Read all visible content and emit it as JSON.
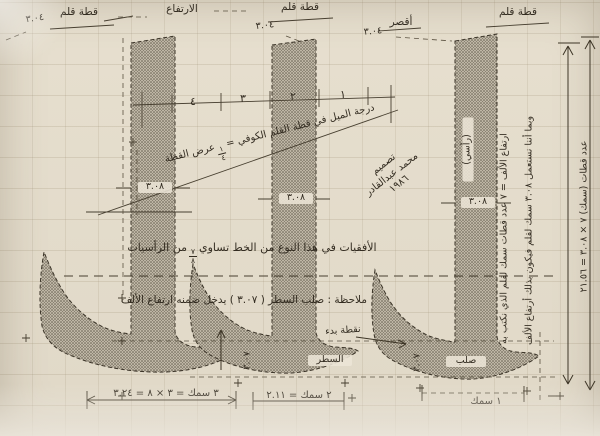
{
  "labels": {
    "pen_cut": "قطة قلم",
    "pen_cut_value": "٣.٠٤",
    "height": "الارتفاع",
    "shorter": "أقصر",
    "ruler_ticks": [
      "٤",
      "٣",
      "٢",
      "١"
    ],
    "slant_pre": "درجة الميل في قطة القلم الكوفي =",
    "slant_frac_num": "١",
    "slant_frac_den": "٤",
    "slant_post": "عرض القطة",
    "stroke_width": "٣.٠٨",
    "vertical": "(رأسي)",
    "horizontals_pre": "الأفقيات في هذا النوع من الخط تساوي",
    "horizontals_frac_num": "٧",
    "horizontals_frac_den": "٨",
    "horizontals_post": "من الرأسيات",
    "note_line": "ملاحظة : صلب السطر ( ٣.٠٧ ) يدخل ضمنه ارتفاع الألف",
    "the_line": "السطر",
    "solid": "صلب",
    "signature_1": "تصميم",
    "signature_2": "محمد عبدالقادر",
    "signature_3": "١٩٨٦",
    "right_line_1": "ارتفاع الألف = ٧ عدد قطات سمك لقلم الذي نكتب به",
    "right_line_2": "وبما أننا نستعمل ٣.٠٨ سمك لقلم فيكون بذلك أرتفاع الألف",
    "right_line_3": "عدد قطات (سمك) ٧ × ٣.٠٨ = ٢١.٥٦",
    "dim_1": "٣ سمك = ٣ × ٨ = ٣.٢٤",
    "dim_2": "٢ سمك = ٢.١١",
    "dim_3": "١ سمك",
    "foot_height": "٣.٠٧",
    "start_point": "نقطة بدء"
  }
}
